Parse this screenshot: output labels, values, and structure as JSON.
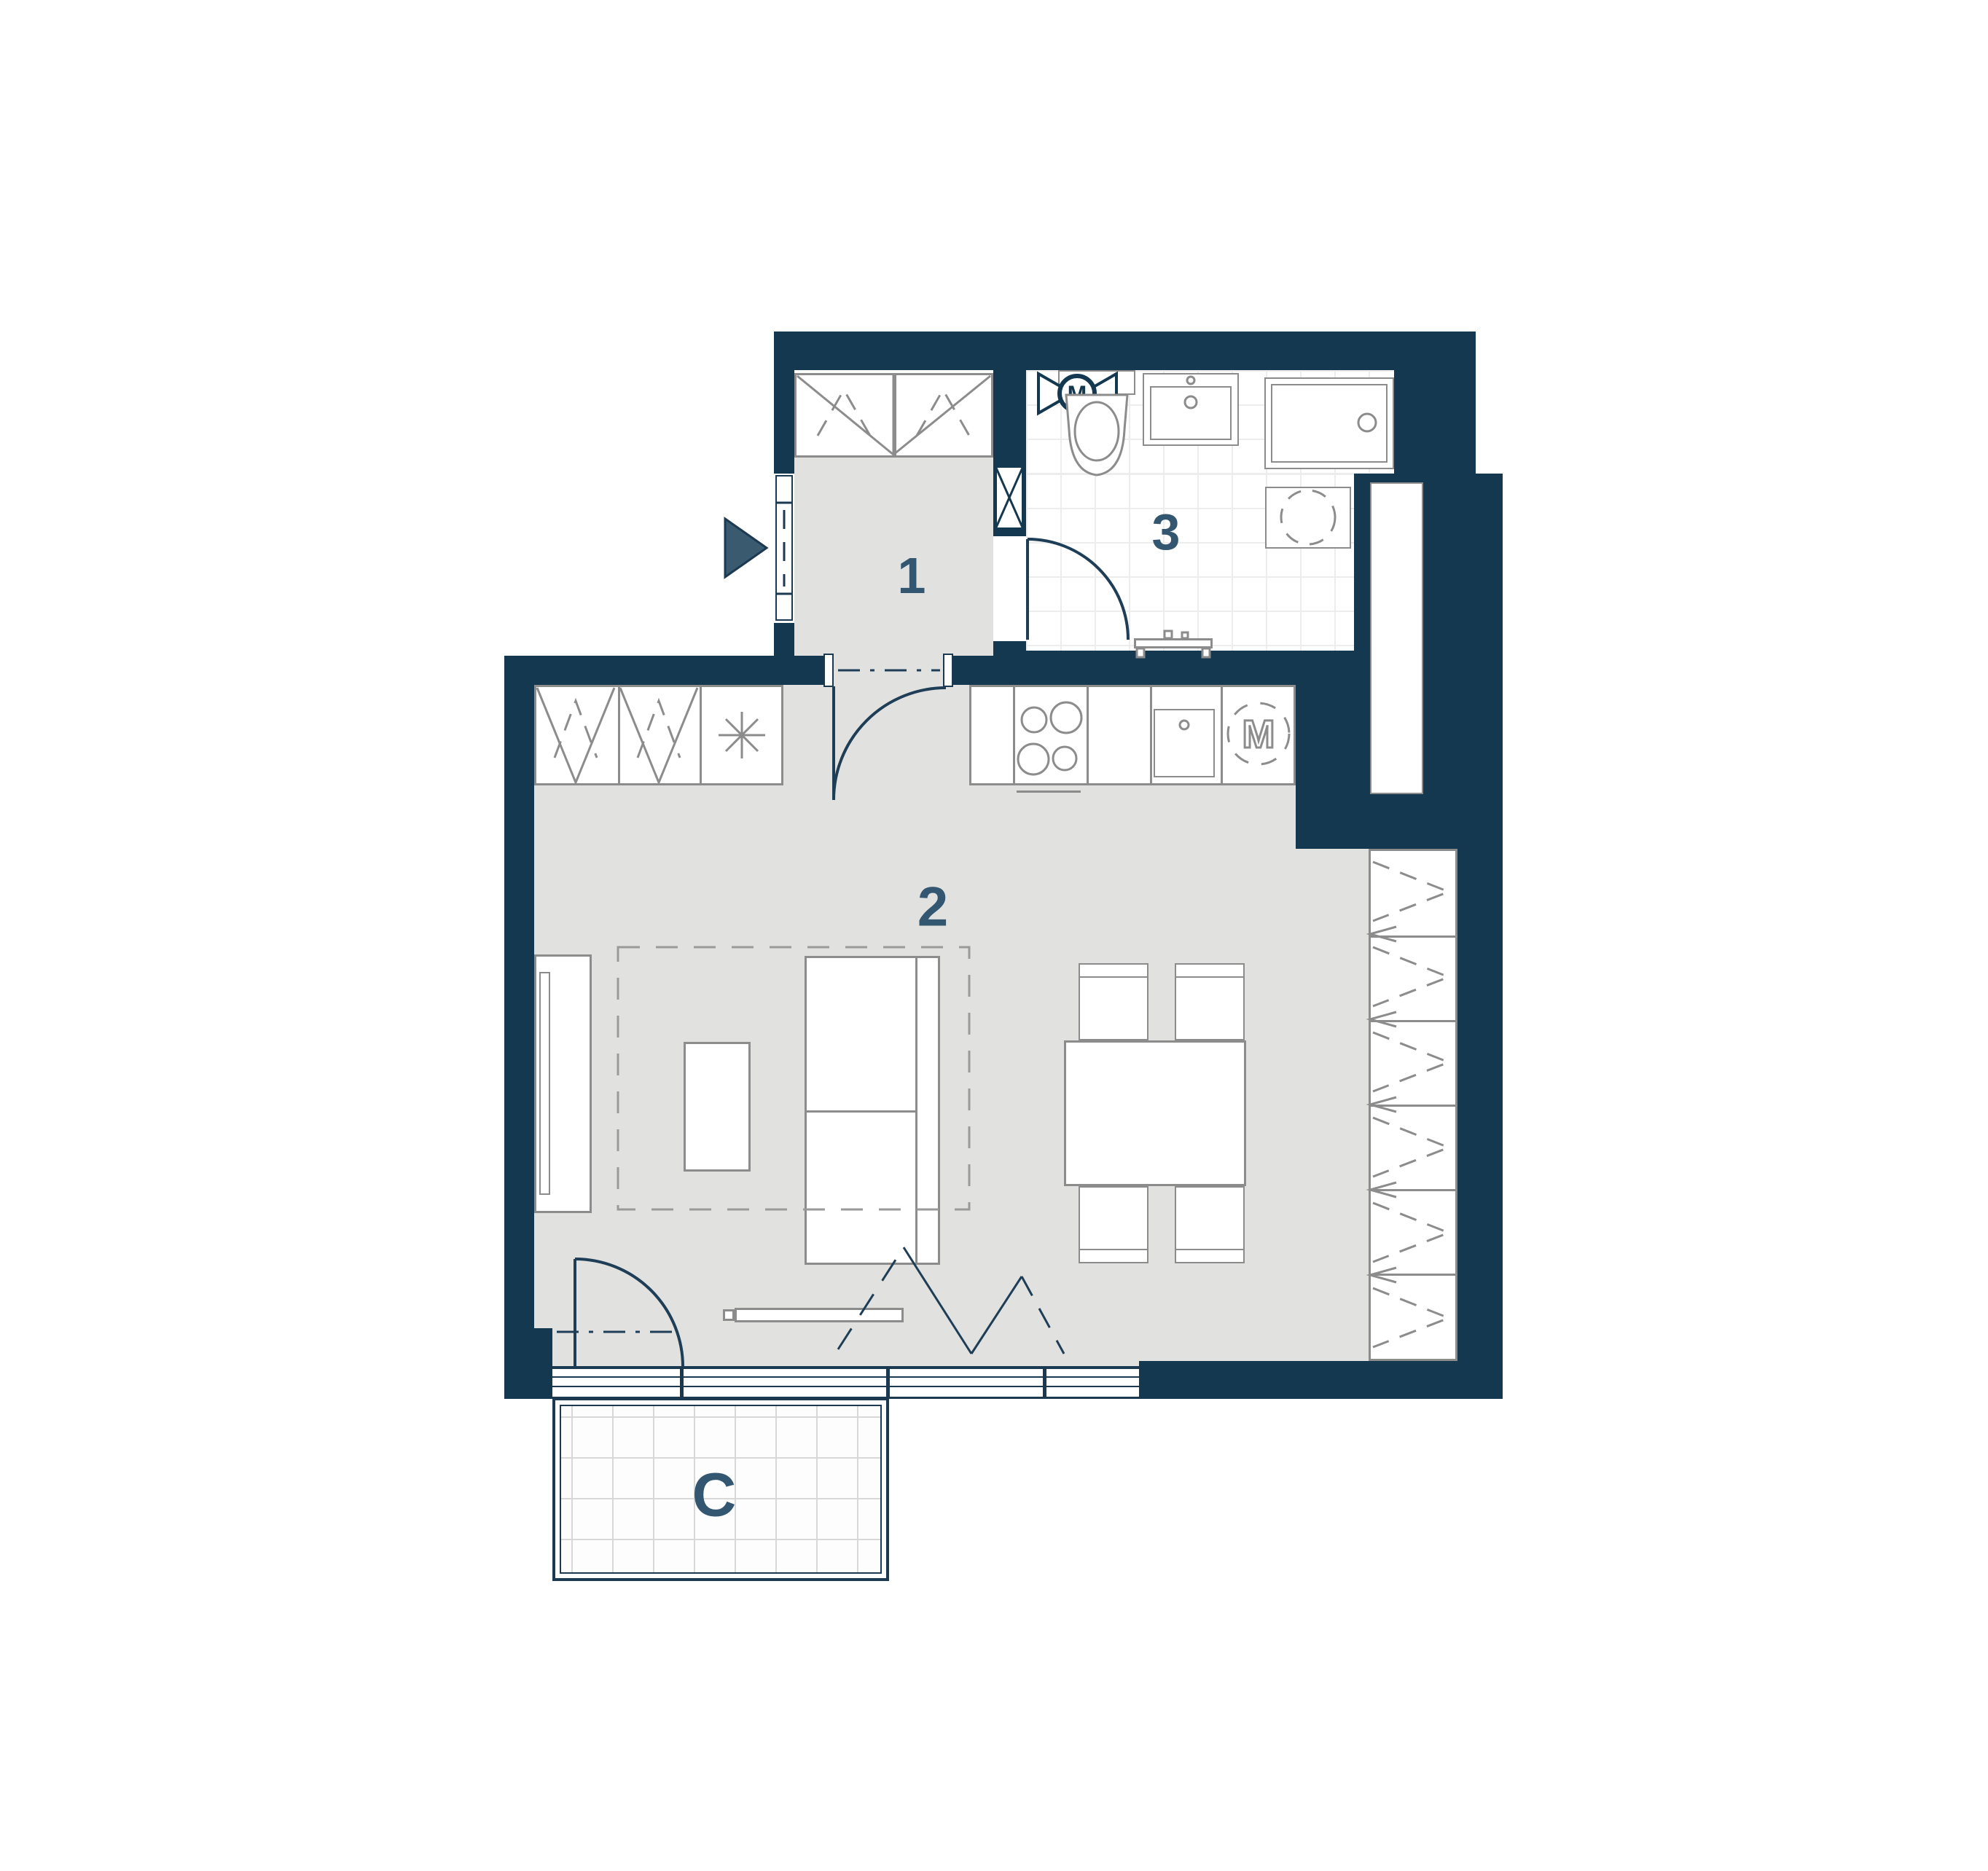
{
  "plan": {
    "title": "studio-apartment-floor-plan",
    "rooms": {
      "hall_number": "1",
      "living_number": "2",
      "bath_number": "3"
    },
    "balcony_label": "C",
    "symbols": {
      "fan_letter": "M",
      "washer_letter": "M"
    },
    "colors": {
      "wall": "#133850",
      "floor": "#e1e1e0",
      "label": "#335770",
      "fixture_outline": "#8c8c8c",
      "line": "#1b3a52",
      "background": "#ffffff"
    }
  }
}
